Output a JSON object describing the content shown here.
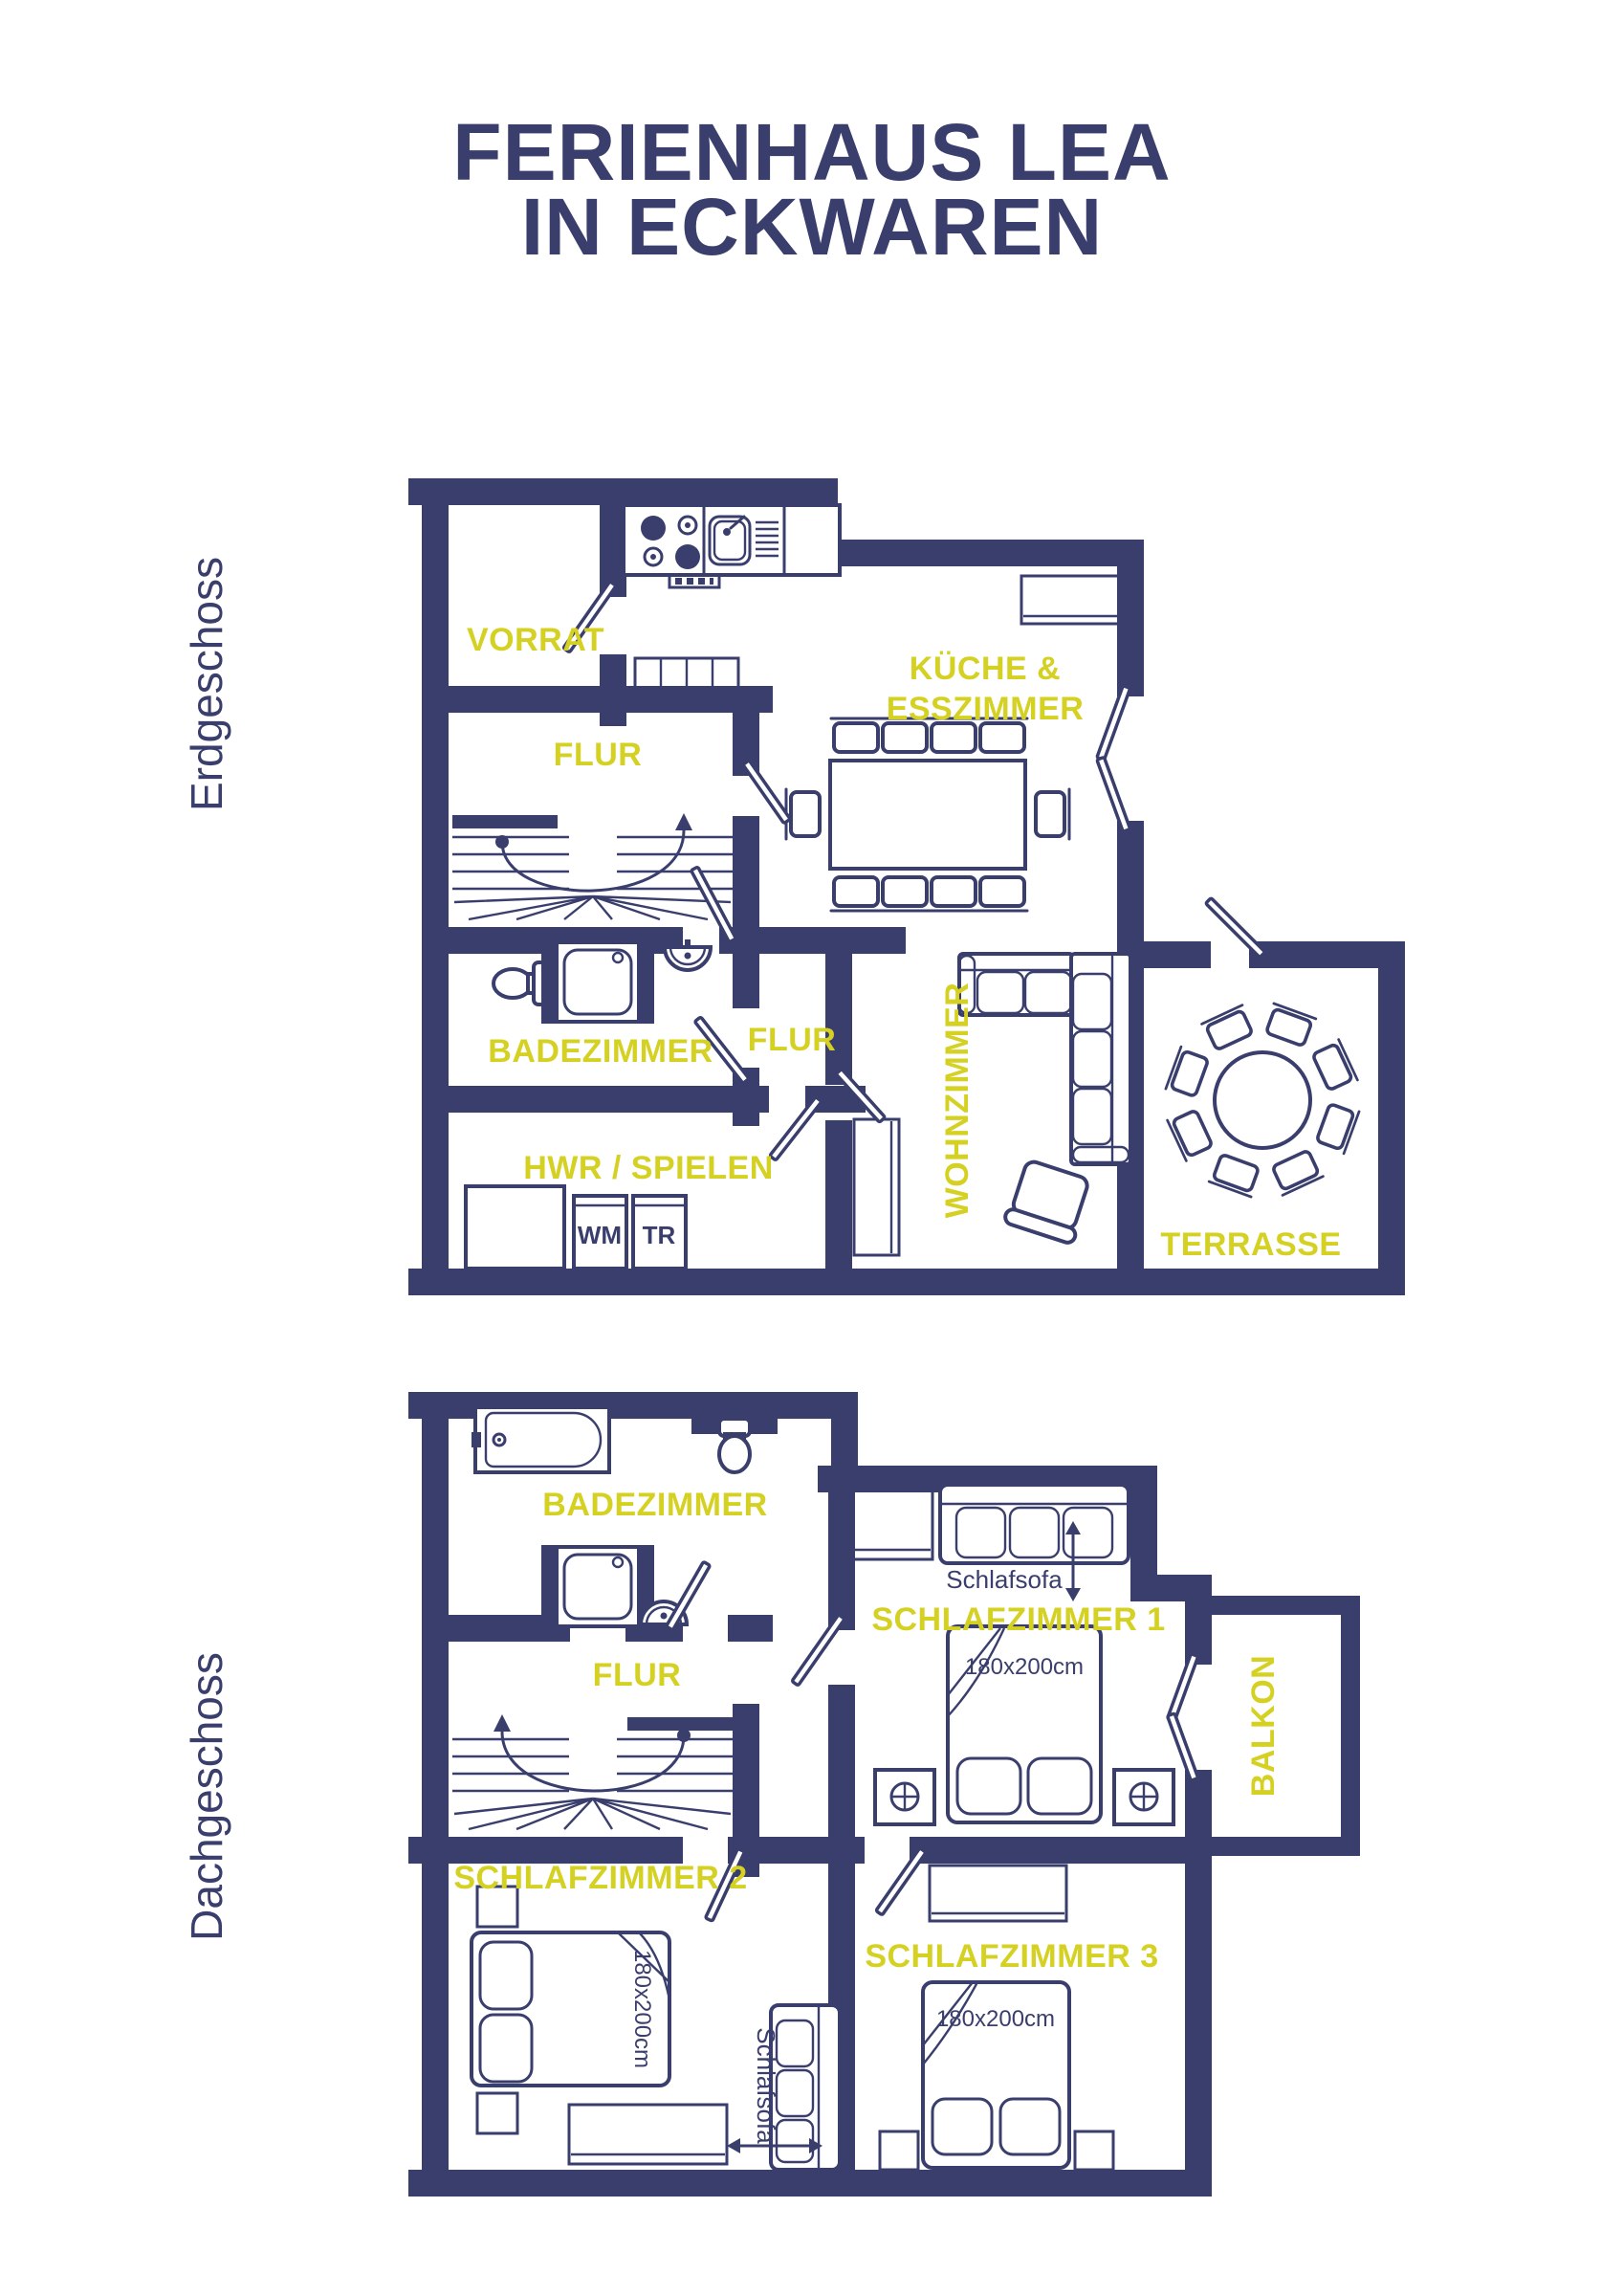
{
  "title": {
    "line1": "FERIENHAUS LEA",
    "line2": "IN ECKWAREN"
  },
  "colors": {
    "navy": "#3a3e6d",
    "yellow": "#d5d122",
    "background": "#ffffff"
  },
  "floors": {
    "ground": {
      "label": "Erdgeschoss",
      "rooms": {
        "vorrat": "VORRAT",
        "flur": "FLUR",
        "kueche1": "KÜCHE &",
        "kueche2": "ESSZIMMER",
        "bad": "BADEZIMMER",
        "flur2": "FLUR",
        "wohnzimmer": "WOHNZIMMER",
        "hwr": "HWR / SPIELEN",
        "terrasse": "TERRASSE"
      },
      "appliances": {
        "wm": "WM",
        "tr": "TR"
      }
    },
    "attic": {
      "label": "Dachgeschoss",
      "rooms": {
        "bad": "BADEZIMMER",
        "flur": "FLUR",
        "sz1": "SCHLAFZIMMER 1",
        "sz2": "SCHLAFZIMMER 2",
        "sz3": "SCHLAFZIMMER 3",
        "balkon": "BALKON"
      },
      "annotations": {
        "sofa1": "Schlafsofa",
        "sofa2": "Schlafsofa",
        "bed1": "180x200cm",
        "bed2": "180x200cm",
        "bed3": "180x200cm"
      }
    }
  }
}
